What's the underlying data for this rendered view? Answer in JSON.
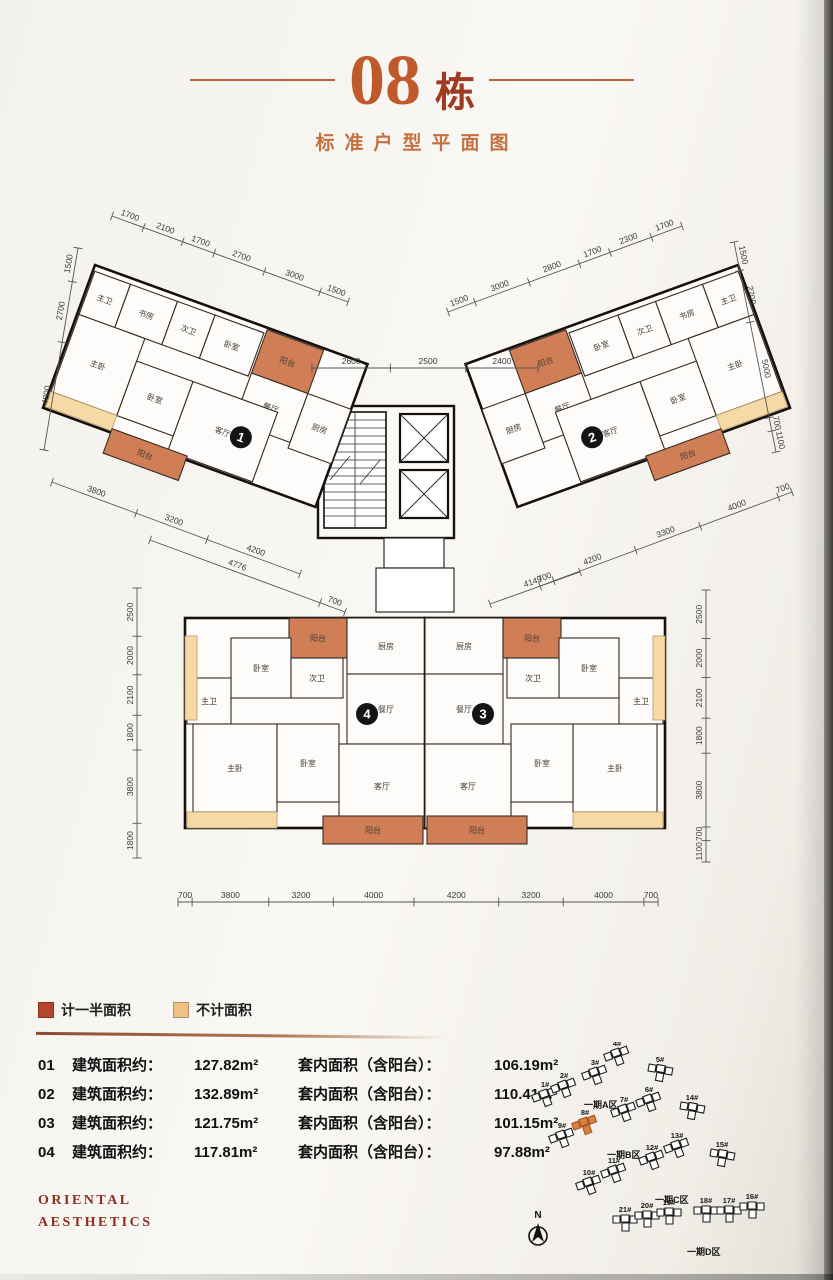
{
  "page": {
    "title_number": "08",
    "title_suffix": "栋",
    "subtitle": "标准户型平面图"
  },
  "legend": {
    "items": [
      {
        "name": "half-area",
        "label": "计一半面积",
        "color": "#b5452b"
      },
      {
        "name": "excluded-area",
        "label": "不计面积",
        "color": "#f0c184"
      }
    ]
  },
  "areas": {
    "gross_label": "建筑面积约：",
    "inner_label": "套内面积（含阳台）：",
    "rows": [
      {
        "no": "01",
        "gross": "127.82m²",
        "inner": "106.19m²"
      },
      {
        "no": "02",
        "gross": "132.89m²",
        "inner": "110.41m²"
      },
      {
        "no": "03",
        "gross": "121.75m²",
        "inner": "101.15m²"
      },
      {
        "no": "04",
        "gross": "117.81m²",
        "inner": "97.88m²"
      }
    ]
  },
  "brand": {
    "line1": "ORIENTAL",
    "line2": "AESTHETICS"
  },
  "plan": {
    "colors": {
      "balcony": "#cf7e55",
      "accent": "#f6d9a4",
      "wall": "#15100c"
    },
    "units": [
      {
        "id": "1",
        "transform": "translate(95,115) rotate(20)",
        "mirror": false,
        "w": 290,
        "h": 152,
        "badge": {
          "x": 196,
          "y": 112,
          "label": "1"
        },
        "rooms": [
          {
            "name": "master-bath",
            "label": "主卫",
            "x": 2,
            "y": 6,
            "w": 38,
            "h": 46
          },
          {
            "name": "study",
            "label": "书房",
            "x": 40,
            "y": 6,
            "w": 50,
            "h": 46
          },
          {
            "name": "second-bath",
            "label": "次卫",
            "x": 90,
            "y": 6,
            "w": 40,
            "h": 46
          },
          {
            "name": "bedroom",
            "label": "卧室",
            "x": 130,
            "y": 6,
            "w": 52,
            "h": 46
          },
          {
            "name": "balcony-top",
            "label": "阳台",
            "x": 184,
            "y": 2,
            "w": 60,
            "h": 46,
            "type": "balcony"
          },
          {
            "name": "dining",
            "label": "餐厅",
            "x": 184,
            "y": 48,
            "w": 60,
            "h": 52
          },
          {
            "name": "kitchen",
            "label": "厨房",
            "x": 244,
            "y": 48,
            "w": 46,
            "h": 58
          },
          {
            "name": "master-bedroom",
            "label": "主卧",
            "x": 2,
            "y": 52,
            "w": 70,
            "h": 82
          },
          {
            "name": "bedroom2",
            "label": "卧室",
            "x": 72,
            "y": 76,
            "w": 60,
            "h": 58
          },
          {
            "name": "living",
            "label": "客厅",
            "x": 132,
            "y": 76,
            "w": 90,
            "h": 74
          },
          {
            "name": "accent-strip",
            "x": 2,
            "y": 134,
            "w": 70,
            "h": 16,
            "type": "accent"
          },
          {
            "name": "balcony-bottom",
            "label": "阳台",
            "x": 72,
            "y": 148,
            "w": 80,
            "h": 26,
            "type": "balcony"
          }
        ]
      },
      {
        "id": "2",
        "transform": "translate(738,115) rotate(-20) scale(-1,1)",
        "mirror": true,
        "w": 290,
        "h": 152,
        "badge": {
          "x": 196,
          "y": 112,
          "label": "2"
        },
        "rooms": [
          {
            "name": "master-bath",
            "label": "主卫",
            "x": 2,
            "y": 6,
            "w": 38,
            "h": 46
          },
          {
            "name": "study",
            "label": "书房",
            "x": 40,
            "y": 6,
            "w": 50,
            "h": 46
          },
          {
            "name": "second-bath",
            "label": "次卫",
            "x": 90,
            "y": 6,
            "w": 40,
            "h": 46
          },
          {
            "name": "bedroom",
            "label": "卧室",
            "x": 130,
            "y": 6,
            "w": 52,
            "h": 46
          },
          {
            "name": "balcony-top",
            "label": "阳台",
            "x": 184,
            "y": 2,
            "w": 60,
            "h": 46,
            "type": "balcony"
          },
          {
            "name": "dining",
            "label": "餐厅",
            "x": 184,
            "y": 48,
            "w": 60,
            "h": 52
          },
          {
            "name": "kitchen",
            "label": "厨房",
            "x": 244,
            "y": 48,
            "w": 46,
            "h": 58
          },
          {
            "name": "master-bedroom",
            "label": "主卧",
            "x": 2,
            "y": 52,
            "w": 70,
            "h": 82
          },
          {
            "name": "bedroom2",
            "label": "卧室",
            "x": 72,
            "y": 76,
            "w": 60,
            "h": 58
          },
          {
            "name": "living",
            "label": "客厅",
            "x": 132,
            "y": 76,
            "w": 90,
            "h": 74
          },
          {
            "name": "accent-strip",
            "x": 2,
            "y": 134,
            "w": 70,
            "h": 16,
            "type": "accent"
          },
          {
            "name": "balcony-bottom",
            "label": "阳台",
            "x": 72,
            "y": 148,
            "w": 80,
            "h": 26,
            "type": "balcony"
          }
        ]
      },
      {
        "id": "4",
        "transform": "translate(185,468)",
        "mirror": false,
        "w": 240,
        "h": 210,
        "badge": {
          "x": 182,
          "y": 96,
          "label": "4"
        },
        "rooms": [
          {
            "name": "balcony-top",
            "label": "阳台",
            "x": 104,
            "y": 0,
            "w": 58,
            "h": 40,
            "type": "balcony"
          },
          {
            "name": "kitchen",
            "label": "厨房",
            "x": 162,
            "y": 0,
            "w": 78,
            "h": 56
          },
          {
            "name": "bedroom",
            "label": "卧室",
            "x": 46,
            "y": 20,
            "w": 60,
            "h": 60
          },
          {
            "name": "second-bath",
            "label": "次卫",
            "x": 106,
            "y": 40,
            "w": 52,
            "h": 40
          },
          {
            "name": "dining",
            "label": "餐厅",
            "x": 162,
            "y": 56,
            "w": 78,
            "h": 70
          },
          {
            "name": "master-bath",
            "label": "主卫",
            "x": 2,
            "y": 60,
            "w": 44,
            "h": 46
          },
          {
            "name": "master-bedroom",
            "label": "主卧",
            "x": 8,
            "y": 106,
            "w": 84,
            "h": 88
          },
          {
            "name": "bedroom2",
            "label": "卧室",
            "x": 92,
            "y": 106,
            "w": 62,
            "h": 78
          },
          {
            "name": "living",
            "label": "客厅",
            "x": 154,
            "y": 126,
            "w": 86,
            "h": 84
          },
          {
            "name": "accent-strip",
            "x": 0,
            "y": 18,
            "w": 12,
            "h": 84,
            "type": "accent"
          },
          {
            "name": "accent-strip2",
            "x": 2,
            "y": 194,
            "w": 90,
            "h": 16,
            "type": "accent"
          },
          {
            "name": "balcony-bottom",
            "label": "阳台",
            "x": 138,
            "y": 198,
            "w": 100,
            "h": 28,
            "type": "balcony"
          }
        ]
      },
      {
        "id": "3",
        "transform": "translate(665,468) scale(-1,1)",
        "mirror": true,
        "w": 240,
        "h": 210,
        "badge": {
          "x": 182,
          "y": 96,
          "label": "3"
        },
        "rooms": [
          {
            "name": "balcony-top",
            "label": "阳台",
            "x": 104,
            "y": 0,
            "w": 58,
            "h": 40,
            "type": "balcony"
          },
          {
            "name": "kitchen",
            "label": "厨房",
            "x": 162,
            "y": 0,
            "w": 78,
            "h": 56
          },
          {
            "name": "bedroom",
            "label": "卧室",
            "x": 46,
            "y": 20,
            "w": 60,
            "h": 60
          },
          {
            "name": "second-bath",
            "label": "次卫",
            "x": 106,
            "y": 40,
            "w": 52,
            "h": 40
          },
          {
            "name": "dining",
            "label": "餐厅",
            "x": 162,
            "y": 56,
            "w": 78,
            "h": 70
          },
          {
            "name": "master-bath",
            "label": "主卫",
            "x": 2,
            "y": 60,
            "w": 44,
            "h": 46
          },
          {
            "name": "master-bedroom",
            "label": "主卧",
            "x": 8,
            "y": 106,
            "w": 84,
            "h": 88
          },
          {
            "name": "bedroom2",
            "label": "卧室",
            "x": 92,
            "y": 106,
            "w": 62,
            "h": 78
          },
          {
            "name": "living",
            "label": "客厅",
            "x": 154,
            "y": 126,
            "w": 86,
            "h": 84
          },
          {
            "name": "accent-strip",
            "x": 0,
            "y": 18,
            "w": 12,
            "h": 84,
            "type": "accent"
          },
          {
            "name": "accent-strip2",
            "x": 2,
            "y": 194,
            "w": 90,
            "h": 16,
            "type": "accent"
          },
          {
            "name": "balcony-bottom",
            "label": "阳台",
            "x": 138,
            "y": 198,
            "w": 100,
            "h": 28,
            "type": "balcony"
          }
        ]
      }
    ],
    "dims": [
      {
        "name": "unit1-top",
        "line": [
          112,
          66,
          348,
          152
        ],
        "labels": [
          "1700",
          "2100",
          "1700",
          "2700",
          "3000",
          "1500"
        ]
      },
      {
        "name": "unit1-left",
        "line": [
          78,
          98,
          44,
          300
        ],
        "labels": [
          "1500",
          "2700",
          "4800"
        ],
        "tadd": 180
      },
      {
        "name": "unit1-bottom",
        "line": [
          52,
          332,
          300,
          424
        ],
        "labels": [
          "3800",
          "3200",
          "4200"
        ]
      },
      {
        "name": "unit1-bottom-2",
        "line": [
          150,
          390,
          345,
          462
        ],
        "labels": [
          "4776",
          "700"
        ]
      },
      {
        "name": "center-top",
        "line": [
          312,
          218,
          538,
          218
        ],
        "labels": [
          "2600",
          "2500",
          "2400"
        ]
      },
      {
        "name": "unit2-top",
        "line": [
          448,
          162,
          682,
          76
        ],
        "labels": [
          "1500",
          "3000",
          "2800",
          "1700",
          "2300",
          "1700"
        ]
      },
      {
        "name": "unit2-right",
        "line": [
          734,
          92,
          776,
          302
        ],
        "labels": [
          "1500",
          "2700",
          "5000",
          "700",
          "1100"
        ]
      },
      {
        "name": "unit2-bottom",
        "line": [
          540,
          436,
          792,
          342
        ],
        "labels": [
          "700",
          "4200",
          "3300",
          "4000",
          "700"
        ]
      },
      {
        "name": "unit2-bottom-2",
        "line": [
          490,
          454,
          580,
          422
        ],
        "labels": [
          "4149"
        ]
      },
      {
        "name": "lower-left",
        "line": [
          137,
          438,
          137,
          708
        ],
        "labels": [
          "2500",
          "2000",
          "2100",
          "1800",
          "3800",
          "1800"
        ],
        "tadd": 180
      },
      {
        "name": "lower-right",
        "line": [
          706,
          440,
          706,
          712
        ],
        "labels": [
          "2500",
          "2000",
          "2100",
          "1800",
          "3800",
          "700",
          "1100"
        ],
        "tadd": 180
      },
      {
        "name": "lower-bottom",
        "line": [
          178,
          752,
          658,
          752
        ],
        "labels": [
          "700",
          "3800",
          "3200",
          "4000",
          "4200",
          "3200",
          "4000",
          "700"
        ]
      }
    ]
  },
  "site": {
    "north_label": "N",
    "zones": [
      {
        "label": "一期A区",
        "x": 62,
        "y": 66
      },
      {
        "label": "一期B区",
        "x": 85,
        "y": 116
      },
      {
        "label": "一期C区",
        "x": 133,
        "y": 161
      },
      {
        "label": "一期D区",
        "x": 165,
        "y": 213
      }
    ],
    "buildings": [
      {
        "label": "1#",
        "x": 23,
        "y": 55,
        "rot": -20
      },
      {
        "label": "2#",
        "x": 42,
        "y": 46,
        "rot": -20
      },
      {
        "label": "3#",
        "x": 73,
        "y": 33,
        "rot": -20
      },
      {
        "label": "4#",
        "x": 95,
        "y": 14,
        "rot": -20
      },
      {
        "label": "5#",
        "x": 138,
        "y": 30,
        "rot": 10
      },
      {
        "label": "6#",
        "x": 127,
        "y": 60,
        "rot": -20
      },
      {
        "label": "7#",
        "x": 102,
        "y": 70,
        "rot": -20
      },
      {
        "label": "14#",
        "x": 170,
        "y": 68,
        "rot": 10
      },
      {
        "label": "8#",
        "x": 63,
        "y": 83,
        "rot": -20,
        "highlight": true
      },
      {
        "label": "9#",
        "x": 40,
        "y": 96,
        "rot": -20
      },
      {
        "label": "13#",
        "x": 155,
        "y": 106,
        "rot": -20
      },
      {
        "label": "12#",
        "x": 130,
        "y": 118,
        "rot": -20
      },
      {
        "label": "15#",
        "x": 200,
        "y": 115,
        "rot": 10
      },
      {
        "label": "11#",
        "x": 92,
        "y": 131,
        "rot": -20
      },
      {
        "label": "10#",
        "x": 67,
        "y": 143,
        "rot": -20
      },
      {
        "label": "18#",
        "x": 184,
        "y": 171,
        "rot": 0
      },
      {
        "label": "17#",
        "x": 207,
        "y": 171,
        "rot": 0
      },
      {
        "label": "16#",
        "x": 230,
        "y": 167,
        "rot": 0
      },
      {
        "label": "21#",
        "x": 103,
        "y": 180,
        "rot": 0
      },
      {
        "label": "20#",
        "x": 125,
        "y": 176,
        "rot": 0
      },
      {
        "label": "19#",
        "x": 147,
        "y": 173,
        "rot": 0
      }
    ]
  }
}
